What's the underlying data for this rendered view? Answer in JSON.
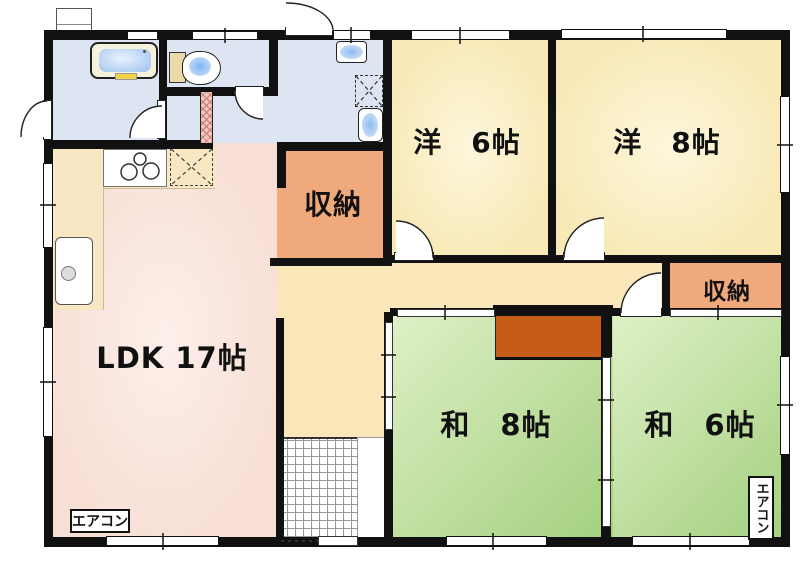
{
  "rooms": {
    "ldk": {
      "label": "LDK 17帖"
    },
    "western6": {
      "label": "洋　6帖"
    },
    "western8": {
      "label": "洋　8帖"
    },
    "japanese8": {
      "label": "和　8帖"
    },
    "japanese6": {
      "label": "和　6帖"
    },
    "storage_upper": {
      "label": "収納"
    },
    "storage_lower": {
      "label": "収納"
    }
  },
  "equipment": {
    "aircon_ldk": "エアコン",
    "aircon_japanese6": "エアコン"
  },
  "fixture_names": [
    "bathtub",
    "toilet",
    "hand-wash-sink",
    "washing-machine-pan",
    "wash-basin",
    "gas-stove",
    "kitchen-sink",
    "entrance-tile",
    "bay-window"
  ],
  "colors": {
    "wall": "#111111",
    "western_room": "#F8E9B6",
    "japanese_room_light": "#DFF0C6",
    "japanese_room_dark": "#A3D07F",
    "ldk": "#F8DFD5",
    "kitchen_zone": "#F7E7C2",
    "corridor": "#FAE8BA",
    "storage": "#F0A87D",
    "closet": "#C65C17",
    "sanitary": "#DEE5F2",
    "water": "#BDD6F6"
  }
}
